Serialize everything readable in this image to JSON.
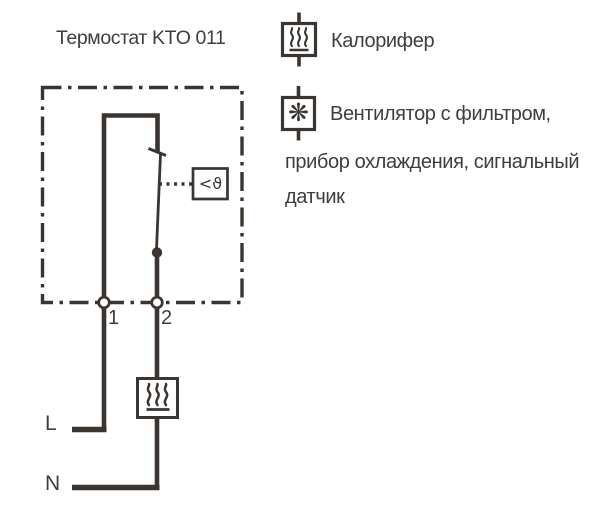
{
  "diagram": {
    "title": "Термостат KTO 011",
    "terminal1": "1",
    "terminal2": "2",
    "line_label": "L",
    "neutral_label": "N",
    "sensor_symbol": "<ϑ"
  },
  "legend": {
    "heater": {
      "icon": "heater-icon",
      "label": "Калорифер"
    },
    "fan": {
      "icon": "fan-icon",
      "glyph": "❋",
      "label_lines": {
        "0": "Вентилятор с фильтром,",
        "1": "прибор охлаждения, сигнальный",
        "2": "датчик"
      }
    }
  },
  "colors": {
    "line": "#3a3531",
    "text": "#413d3b",
    "background": "#ffffff"
  }
}
